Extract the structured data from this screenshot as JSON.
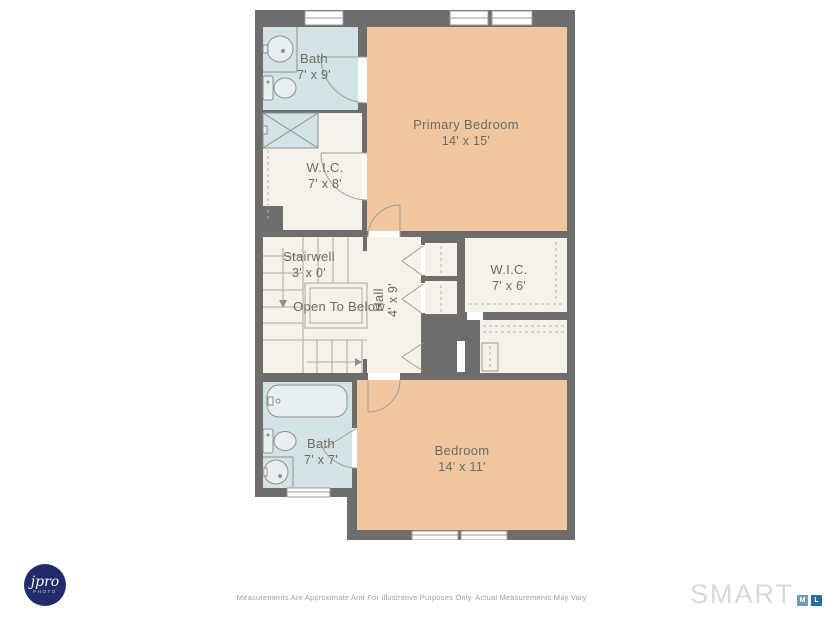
{
  "floorplan": {
    "rooms": {
      "bath_top": {
        "name": "Bath",
        "dims": "7' x 9'"
      },
      "primary_bedroom": {
        "name": "Primary Bedroom",
        "dims": "14' x 15'"
      },
      "wic_top": {
        "name": "W.I.C.",
        "dims": "7' x 8'"
      },
      "stairwell": {
        "name": "Stairwell",
        "dims": "3' x 0'"
      },
      "open_to_below": {
        "label": "Open To Below"
      },
      "hall": {
        "name": "Hall",
        "dims": "4' x 9'"
      },
      "wic_right": {
        "name": "W.I.C.",
        "dims": "7' x 6'"
      },
      "bath_bottom": {
        "name": "Bath",
        "dims": "7' x 7'"
      },
      "bedroom": {
        "name": "Bedroom",
        "dims": "14' x 11'"
      }
    },
    "colors": {
      "wall": "#6e6d6b",
      "bathroom_floor": "#d3e2e5",
      "bedroom_floor": "#f0c7a1",
      "room_floor": "#f6f1e9",
      "line": "#a9a7a2",
      "label_text": "#6b6b63"
    }
  },
  "footer": {
    "disclaimer": "Measurements Are Approximate And For Illustrative Purposes Only. Actual Measurements May Vary."
  },
  "branding": {
    "photographer": {
      "initial": "j",
      "script": "pro",
      "sub": "PHOTO",
      "color": "#232c6a"
    },
    "mls": {
      "wordmark": "SMART",
      "blocks": [
        {
          "letter": "M",
          "color": "#6f9fb2"
        },
        {
          "letter": "L",
          "color": "#2d6da5"
        },
        {
          "letter": "S",
          "color": "#1b2a47"
        }
      ]
    }
  }
}
